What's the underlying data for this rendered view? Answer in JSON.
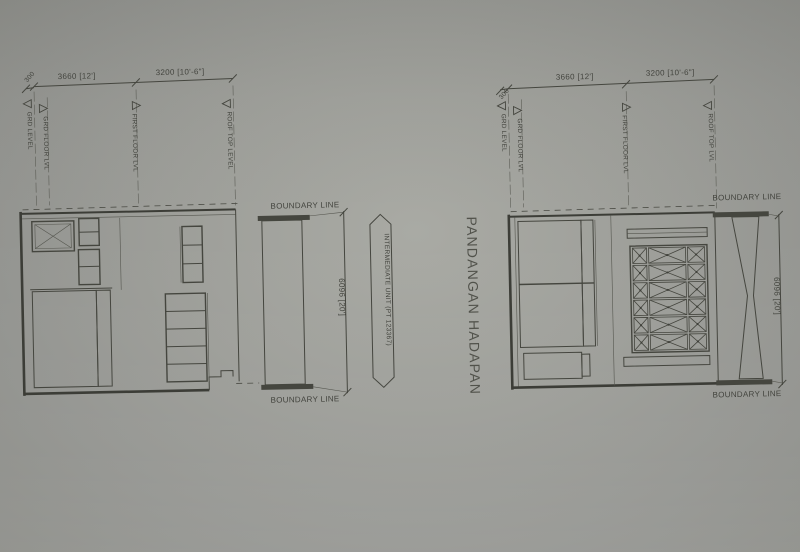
{
  "drawing": {
    "title": "PANDANGAN HADAPAN",
    "left_view": {
      "dim_span_left": "3660 [12']",
      "dim_span_right": "3200 [10'-6\"]",
      "dim_offset": "300",
      "dim_height": "6096 [20']",
      "level_grd": "GRD LEVEL",
      "level_grd_floor": "GRD FLOOR LVL",
      "level_first_floor": "FIRST FLOOR LVL",
      "level_roof_top": "ROOF TOP LEVEL",
      "boundary_top": "BOUNDARY LINE",
      "boundary_bottom": "BOUNDARY LINE",
      "intermediate_unit": "INTERMEDIATE UNIT (PT 123367)"
    },
    "right_view": {
      "dim_span_left": "3660 [12']",
      "dim_span_right": "3200 [10'-6\"]",
      "dim_offset": "300",
      "dim_height": "6096 [20']",
      "level_grd": "GRD LEVEL",
      "level_grd_floor": "GRD FLOOR LVL",
      "level_first_floor": "FIRST FLOOR LVL",
      "level_roof_top": "ROOF TOP LVL",
      "boundary_top": "BOUNDARY LINE",
      "boundary_bottom": "BOUNDARY LINE"
    }
  },
  "colors": {
    "paper": "#9b9c97",
    "ink": "#3e3f39"
  }
}
